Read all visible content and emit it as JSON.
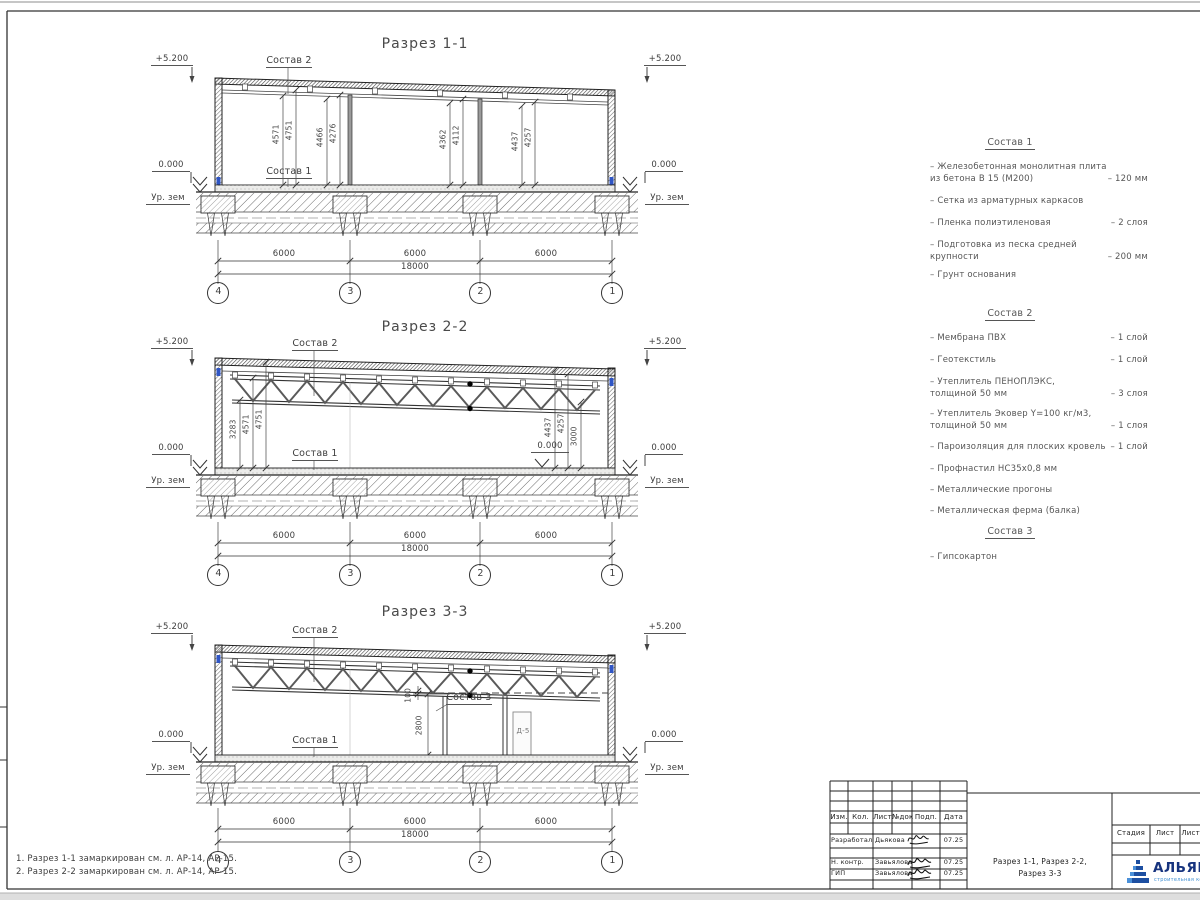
{
  "sections": [
    {
      "title": "Разрез 1-1",
      "elev": "+5.200",
      "zero": "0.000",
      "ground": "Ур. зем",
      "sostav1": "Состав 1",
      "sostav2": "Состав 2",
      "vdims": [
        "4571",
        "4751",
        "4466",
        "4276",
        "4362",
        "4112",
        "4437",
        "4257"
      ],
      "spans": [
        "6000",
        "6000",
        "6000"
      ],
      "total": "18000",
      "axes": [
        "4",
        "3",
        "2",
        "1"
      ]
    },
    {
      "title": "Разрез 2-2",
      "elev": "+5.200",
      "zero": "0.000",
      "inner_zero": "0.000",
      "ground": "Ур. зем",
      "sostav1": "Состав 1",
      "sostav2": "Состав 2",
      "vdims": [
        "3283",
        "4571",
        "4751",
        "4437",
        "4257",
        "3000"
      ],
      "spans": [
        "6000",
        "6000",
        "6000"
      ],
      "total": "18000",
      "axes": [
        "4",
        "3",
        "2",
        "1"
      ]
    },
    {
      "title": "Разрез 3-3",
      "elev": "+5.200",
      "zero": "0.000",
      "ground": "Ур. зем",
      "sostav1": "Состав 1",
      "sostav2": "Состав 2",
      "sostav3": "Состав 3",
      "door_label": "Д-5",
      "vdims": [
        "100",
        "2800"
      ],
      "spans": [
        "6000",
        "6000",
        "6000"
      ],
      "total": "18000",
      "axes": [
        "4",
        "3",
        "2",
        "1"
      ]
    }
  ],
  "legend": {
    "s1": {
      "title": "Состав 1",
      "items": [
        {
          "name": "– Железобетонная  монолитная плита",
          "name2": "из бетона В 15 (М200)",
          "value": "– 120 мм"
        },
        {
          "name": "– Сетка из арматурных каркасов",
          "value": ""
        },
        {
          "name": "– Пленка полиэтиленовая",
          "value": "– 2 слоя"
        },
        {
          "name": "– Подготовка из песка средней",
          "name2": "крупности",
          "value": "– 200 мм"
        },
        {
          "name": "– Грунт основания",
          "value": ""
        }
      ]
    },
    "s2": {
      "title": "Состав 2",
      "items": [
        {
          "name": "– Мембрана ПВХ",
          "value": "– 1 слой"
        },
        {
          "name": "– Геотекстиль",
          "value": "– 1 слой"
        },
        {
          "name": "– Утеплитель ПЕНОПЛЭКС,",
          "name2": "толщиной 50 мм",
          "value": "– 3 слоя"
        },
        {
          "name": "– Утеплитель Эковер Y=100 кг/м3,",
          "name2": "толщиной 50 мм",
          "value": "– 1 слоя"
        },
        {
          "name": "– Пароизоляция для плоских кровель",
          "value": "– 1 слой"
        },
        {
          "name": "– Профнастил НС35х0,8 мм",
          "value": ""
        },
        {
          "name": "– Металлические прогоны",
          "value": ""
        },
        {
          "name": "– Металлическая ферма (балка)",
          "value": ""
        }
      ]
    },
    "s3": {
      "title": "Состав 3",
      "items": [
        {
          "name": "– Гипсокартон",
          "value": ""
        }
      ]
    }
  },
  "notes": [
    "1. Разрез 1-1 замаркирован см. л. АР-14, АР-15.",
    "2. Разрез 2-2 замаркирован см. л. АР-14, АР-15."
  ],
  "titleblock": {
    "columns": [
      "Изм.",
      "Кол.",
      "Лист",
      "№док",
      "Подп.",
      "Дата"
    ],
    "rows": [
      {
        "role": "Разработал",
        "name": "Дьякова",
        "date": "07.25"
      },
      {
        "role": "Н. контр.",
        "name": "Завьялова",
        "date": "07.25"
      },
      {
        "role": "ГИП",
        "name": "Завьялова",
        "date": "07.25"
      }
    ],
    "doc_title1": "Разрез 1-1, Разрез 2-2,",
    "doc_title2": "Разрез 3-3",
    "stage": [
      "Стадия",
      "Лист",
      "Листов"
    ],
    "logo": {
      "text": "АЛЬЯНС",
      "sub": "строительная компания",
      "color": "#1c3f8e"
    }
  }
}
